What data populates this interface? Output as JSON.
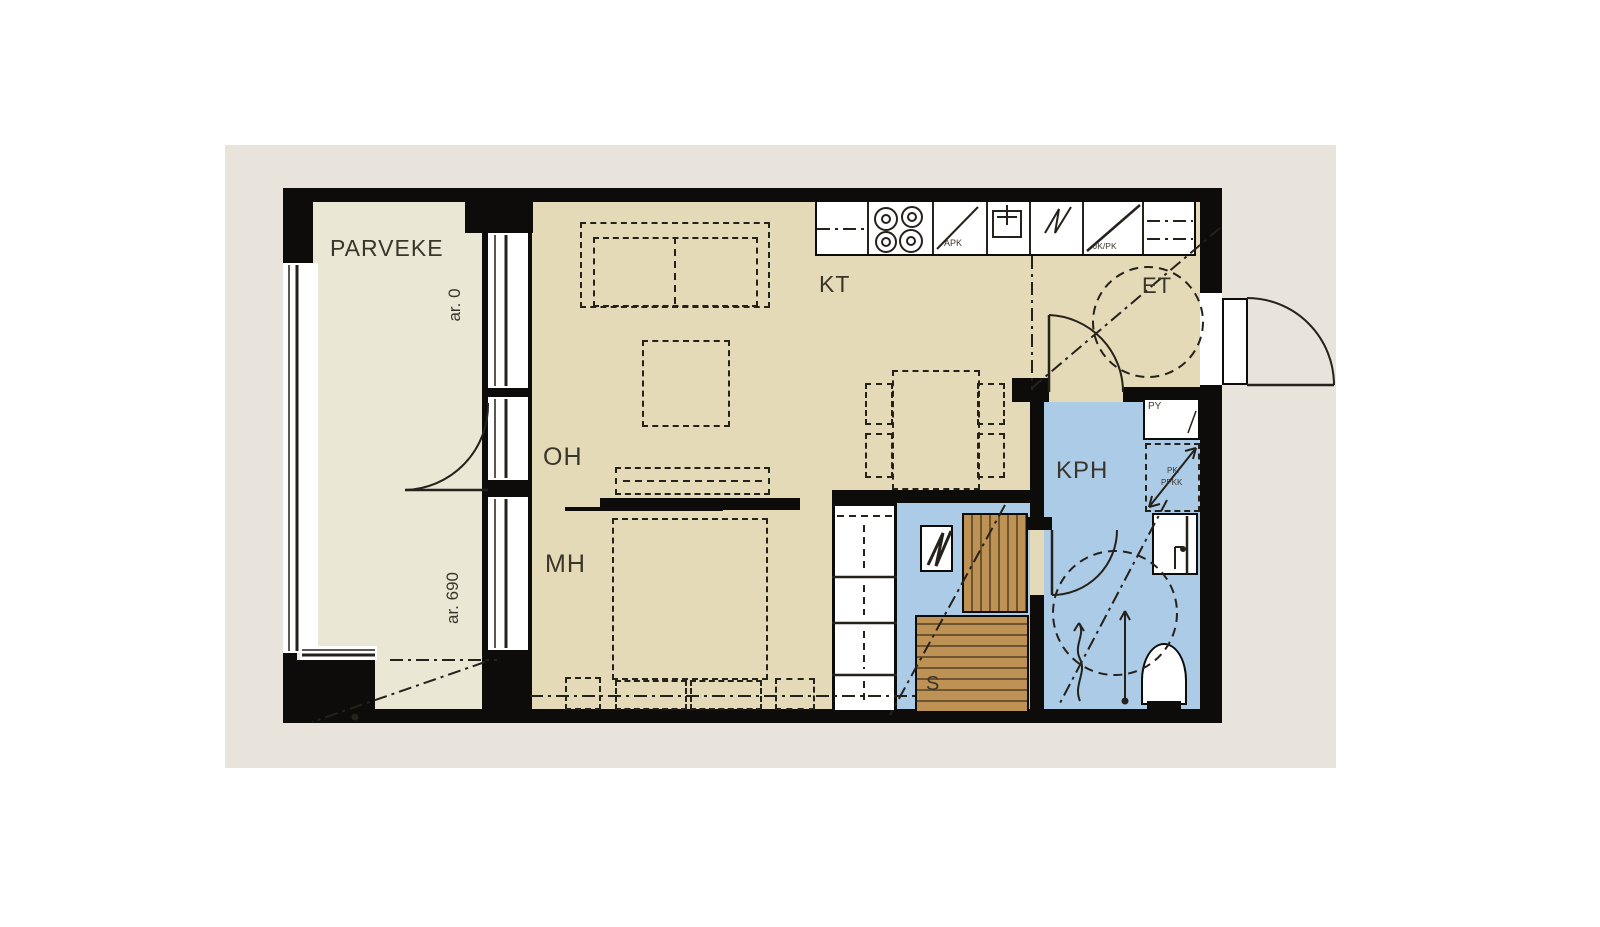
{
  "plan": {
    "colors": {
      "bg": "#e8e4dc",
      "floor": "#e5dab7",
      "balcony": "#eae7d5",
      "wet": "#accbe7",
      "wood": "#bd9254",
      "wall": "#0d0c0a",
      "line": "#25211b",
      "label": "#3a352b"
    },
    "labels": {
      "parveke": "PARVEKE",
      "oh": "OH",
      "mh": "MH",
      "kt": "KT",
      "et": "ET",
      "kph": "KPH",
      "s": "S",
      "ar_top": "ar. 0",
      "ar_bottom": "ar. 690"
    },
    "appliances": {
      "apk": "APK",
      "jk_pk": "JK/PK",
      "py": "PY",
      "res_line1": "PK/",
      "res_line2": "PPKK"
    }
  }
}
